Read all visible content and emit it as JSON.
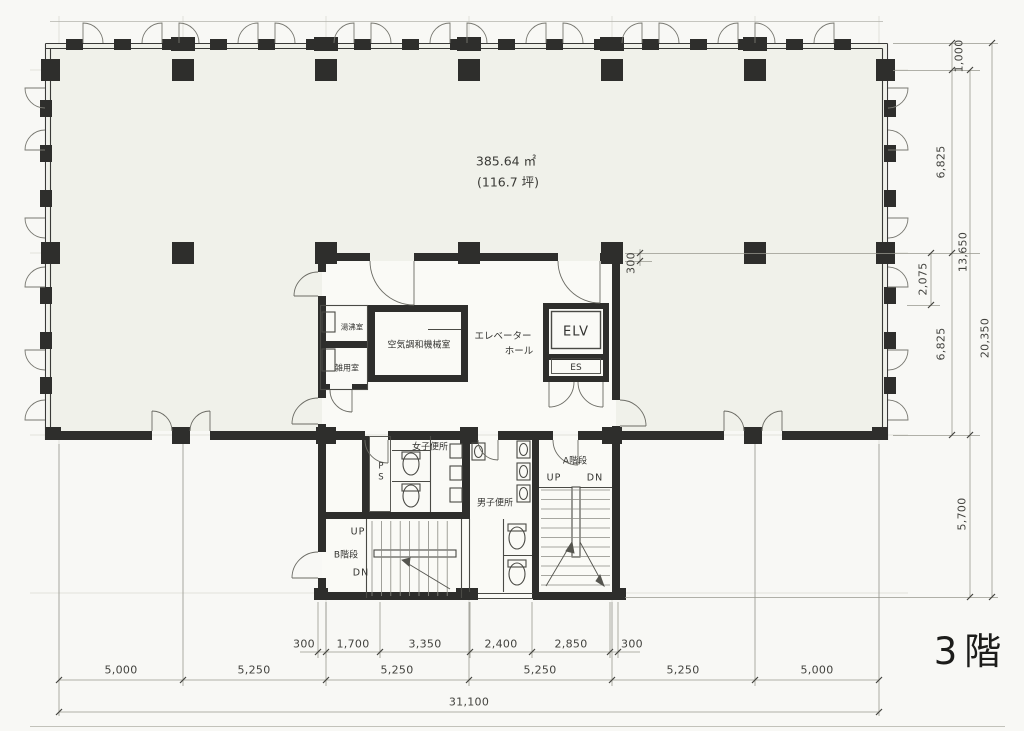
{
  "floor": {
    "label": "3階"
  },
  "area": {
    "m2": "385.64 ㎡",
    "tsubo": "(116.7 坪)"
  },
  "rooms": {
    "machine_room": "空気調和機械室",
    "kitchenette": "湯沸室",
    "utility_room": "雑用室",
    "elevator_hall_1": "エレベーター",
    "elevator_hall_2": "ホール",
    "elevator": "ELV",
    "elevator_es": "ES",
    "pipe_shaft": "PS",
    "womens_toilet": "女子便所",
    "mens_toilet": "男子便所",
    "stair_a": "A階段",
    "stair_b": "B階段"
  },
  "stairs": {
    "up": "UP",
    "down": "DN"
  },
  "dims": {
    "offset_top": "1,000",
    "bay_upper": "6,825",
    "span_upper": "13,650",
    "hall_depth": "2,075",
    "bay_lower": "6,825",
    "span_total_right": "20,350",
    "core_depth": "5,700",
    "wall_offset": "300",
    "core_widths": [
      "300",
      "1,700",
      "3,350",
      "2,400",
      "2,850",
      "300"
    ],
    "bays_bottom": [
      "5,000",
      "5,250",
      "5,250",
      "5,250",
      "5,250",
      "5,000"
    ],
    "total_width": "31,100"
  },
  "colors": {
    "wall": "#2e2e2c",
    "slab": "#f0f1ea",
    "line": "#8d8d86"
  }
}
